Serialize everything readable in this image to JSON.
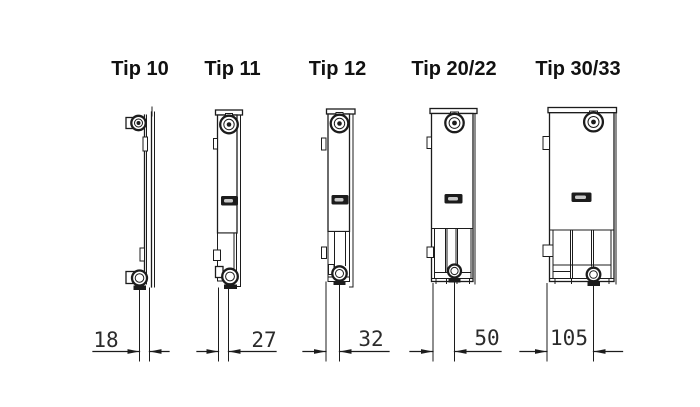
{
  "diagram": {
    "background": "#ffffff",
    "line_color": "#1c1c1c",
    "description": "Radiator type side profiles with depth dimensions",
    "types": [
      {
        "label": "Tip 10",
        "depth_mm": "18"
      },
      {
        "label": "Tip 11",
        "depth_mm": "27"
      },
      {
        "label": "Tip 12",
        "depth_mm": "32"
      },
      {
        "label": "Tip 20/22",
        "depth_mm": "50"
      },
      {
        "label": "Tip 30/33",
        "depth_mm": "105"
      }
    ]
  }
}
